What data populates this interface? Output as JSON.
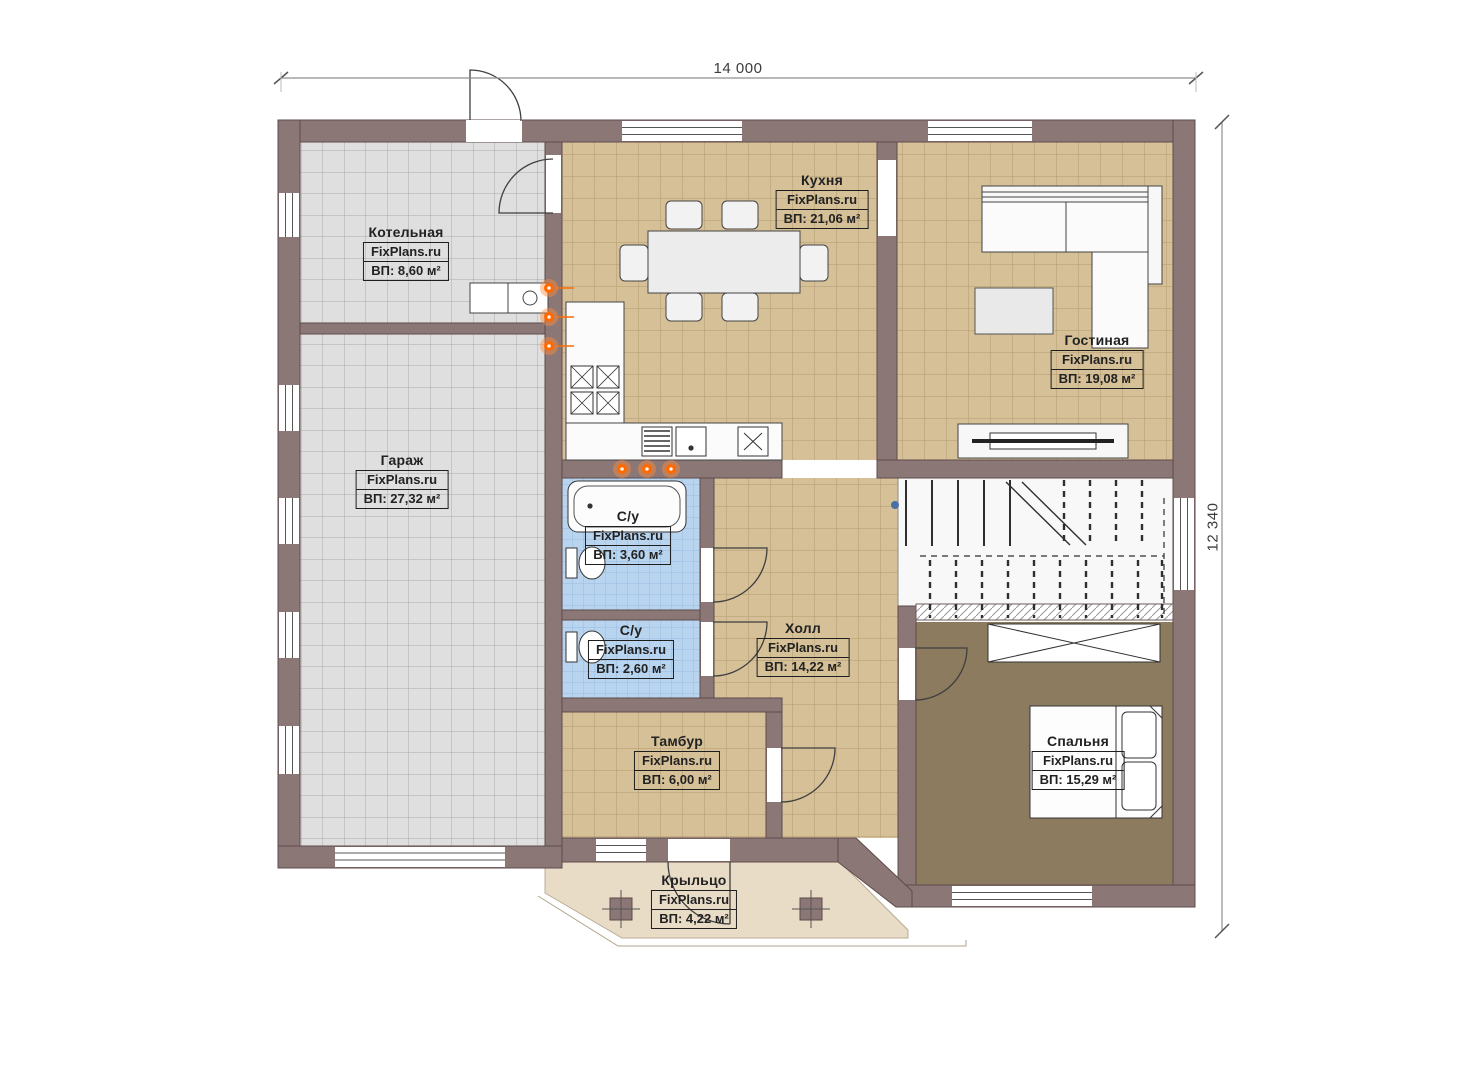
{
  "plan": {
    "dimensions": {
      "width_label": "14 000",
      "height_label": "12 340"
    },
    "watermark": "FixPlans.ru",
    "rooms": [
      {
        "id": "kotelnaya",
        "name": "Котельная",
        "brand": "FixPlans.ru",
        "area": "ВП: 8,60 м²"
      },
      {
        "id": "kuhnya",
        "name": "Кухня",
        "brand": "FixPlans.ru",
        "area": "ВП: 21,06 м²"
      },
      {
        "id": "gostinaya",
        "name": "Гостиная",
        "brand": "FixPlans.ru",
        "area": "ВП: 19,08 м²"
      },
      {
        "id": "garazh",
        "name": "Гараж",
        "brand": "FixPlans.ru",
        "area": "ВП: 27,32 м²"
      },
      {
        "id": "su-top",
        "name": "С/у",
        "brand": "FixPlans.ru",
        "area": "ВП: 3,60 м²"
      },
      {
        "id": "su-bottom",
        "name": "С/у",
        "brand": "FixPlans.ru",
        "area": "ВП: 2,60 м²"
      },
      {
        "id": "holl",
        "name": "Холл",
        "brand": "FixPlans.ru",
        "area": "ВП: 14,22 м²"
      },
      {
        "id": "tambur",
        "name": "Тамбур",
        "brand": "FixPlans.ru",
        "area": "ВП: 6,00 м²"
      },
      {
        "id": "spalnya",
        "name": "Спальня",
        "brand": "FixPlans.ru",
        "area": "ВП: 15,29 м²"
      },
      {
        "id": "krylco",
        "name": "Крыльцо",
        "brand": "FixPlans.ru",
        "area": "ВП: 4,22 м²"
      }
    ],
    "colors": {
      "wall": "#8c7777",
      "tile_grey": "#dfdfdf",
      "tile_tan": "#d5c098",
      "tile_blue": "#b9d4ef",
      "floor_bedroom": "#8d7b5f",
      "floor_porch": "#e9dcc7",
      "marker_orange": "#ff6a00"
    }
  }
}
